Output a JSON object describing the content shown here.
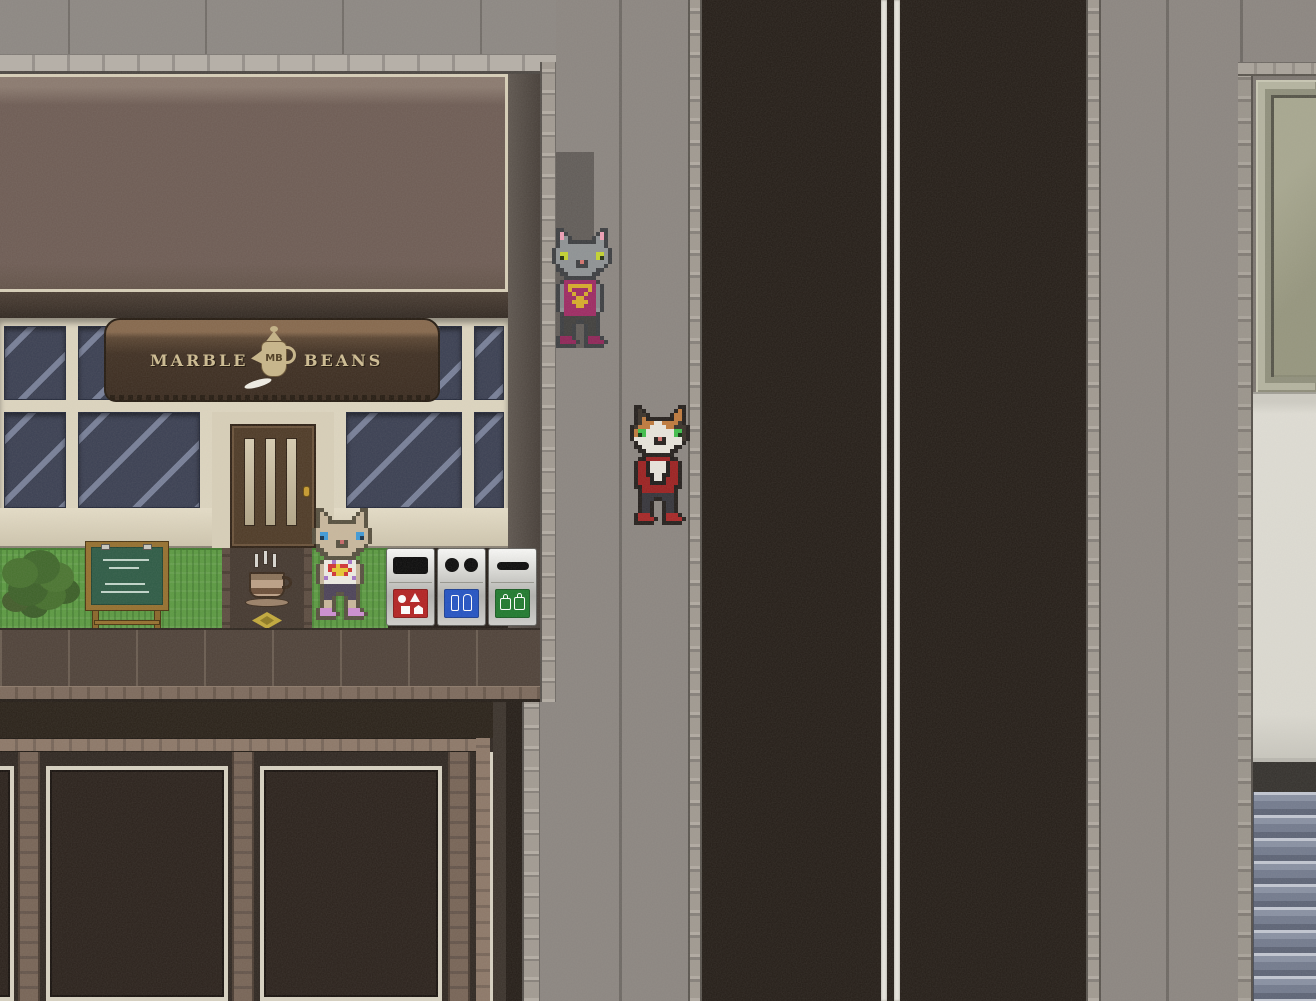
{
  "sign": {
    "left": "MARBLE",
    "right": "BEANS",
    "monogram": "MB"
  },
  "npcs": [
    {
      "name": "gray cat in magenta tank top with gold cross necklace"
    },
    {
      "name": "calico cat in red jacket"
    },
    {
      "name": "tan cat in white and purple top"
    }
  ],
  "bins": [
    {
      "name": "general waste bin",
      "color": "#b42222"
    },
    {
      "name": "bottles and cans bin",
      "color": "#2353c4"
    },
    {
      "name": "bags recycling bin",
      "color": "#1f7a2d"
    }
  ],
  "shop": {
    "door": "wooden door with three glass panels",
    "chalkboard": "menu chalkboard with chalk writing"
  },
  "palette": {
    "road": "#241d17",
    "sidewalk": "#8c8681",
    "lane_line": "#e9e6df",
    "awning_facade": "#6e5c54",
    "sign_wood": "#3f2f22",
    "window_glass": "#3a3f52",
    "window_frame": "#ded6c0",
    "grass": "#5b9a41",
    "right_building_window": "#9e9e88",
    "shutter": "#7b8294",
    "lower_wall": "#2f2721"
  }
}
